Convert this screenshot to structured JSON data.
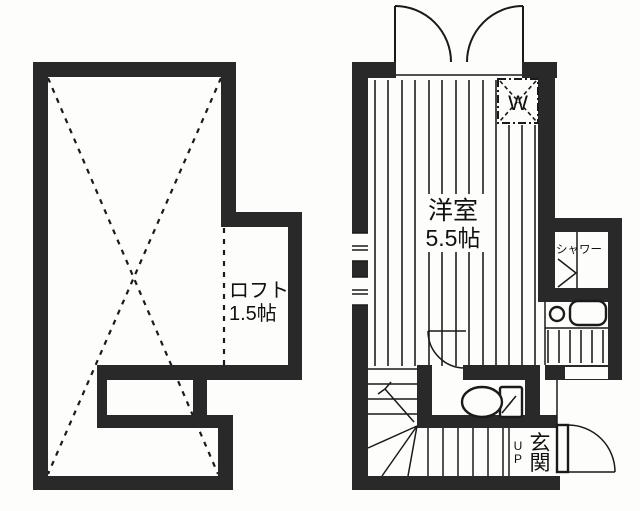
{
  "floorplan": {
    "left_plan": {
      "loft_label_line1": "ロフト",
      "loft_label_line2": "1.5帖"
    },
    "right_plan": {
      "room_label_line1": "洋室",
      "room_label_line2": "5.5帖",
      "closet_label": "W",
      "shower_label": "シャワー",
      "entrance_label_char1": "玄",
      "entrance_label_char2": "関",
      "up_label_char1": "U",
      "up_label_char2": "P"
    },
    "colors": {
      "wall": "#292929",
      "line": "#1a1a1a",
      "background": "#fdfdfb"
    }
  }
}
